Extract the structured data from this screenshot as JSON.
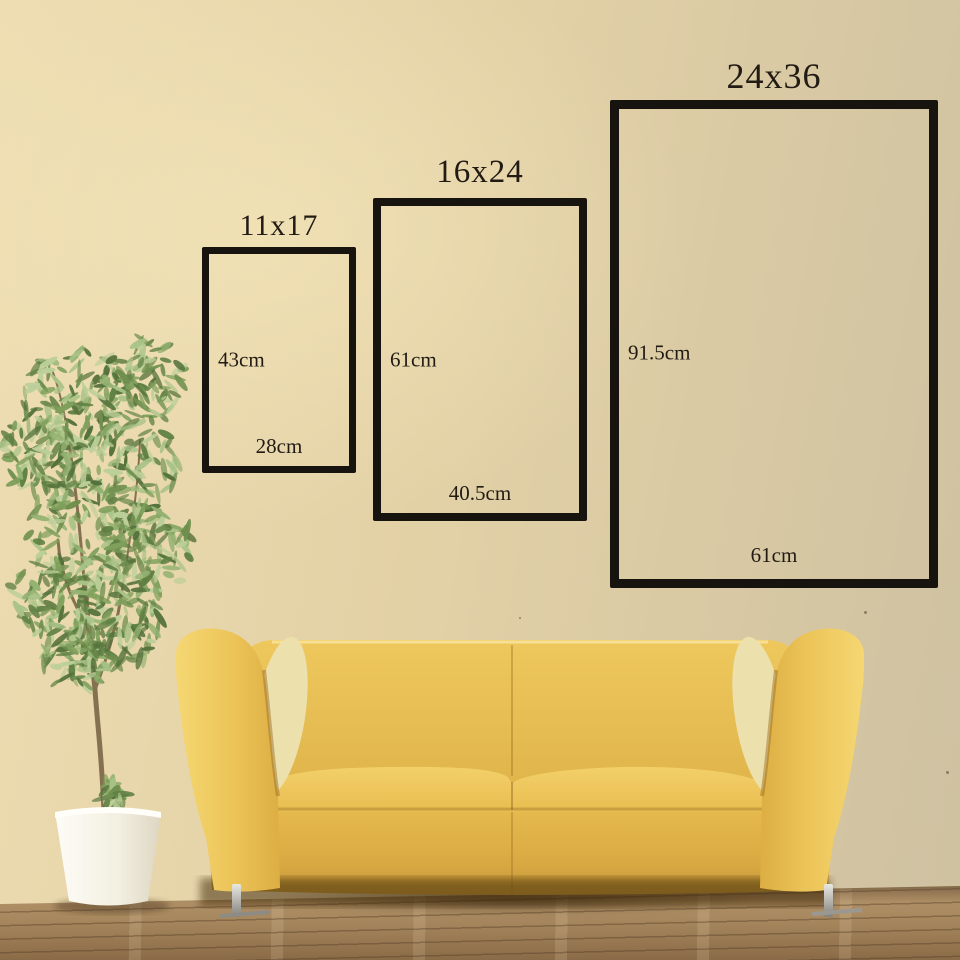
{
  "size_chart": {
    "frames": [
      {
        "name": "11x17",
        "height_label": "43cm",
        "width_label": "28cm"
      },
      {
        "name": "16x24",
        "height_label": "61cm",
        "width_label": "40.5cm"
      },
      {
        "name": "24x36",
        "height_label": "91.5cm",
        "width_label": "61cm"
      }
    ]
  },
  "colors": {
    "wall": "#e3d1a6",
    "wall_light": "#eeddb2",
    "wall_shade": "#cec1a1",
    "outline": "#17130e",
    "text": "#211b14",
    "sofa_yellow": "#ecc254",
    "sofa_shadow": "#c2953a",
    "floor": "#a98a60",
    "pot_white": "#f5f2e9",
    "foliage_green": "#7fa05c"
  }
}
